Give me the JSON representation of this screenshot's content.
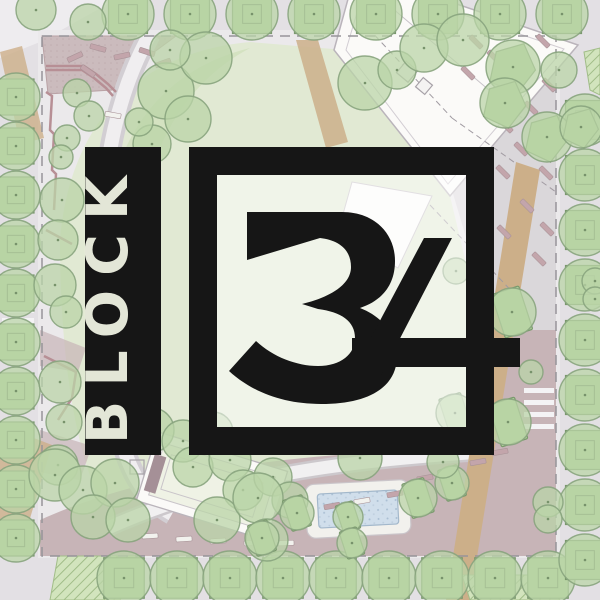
{
  "logo": {
    "block_label": "BLOCK",
    "number": "34",
    "colors": {
      "bar": "#161616",
      "frame": "#161616",
      "letters": "#ecefdf",
      "interior_wash": "rgba(255,255,255,0.5)"
    }
  },
  "site_plan": {
    "palette": {
      "street": "#e1dee2",
      "sidewalk": "#eae8ea",
      "lawn": "#dfe8d0",
      "lawn_bright": "#cfdfba",
      "tree_fill": "#b6d2a2",
      "tree_stroke": "#7f9d74",
      "planter_fill": "#abcd94",
      "planter_stroke": "#6f9161",
      "plaza_mauve": "#c8b6b8",
      "plaza_south": "#c3afb2",
      "plaza_gray": "#d8d4d8",
      "path_gray": "#cfcbd0",
      "path_light": "#efedef",
      "building": "#fbfaf8",
      "building_stroke": "#b5afb6",
      "tan_path": "#c9a981",
      "water": "#cddcea",
      "water_stroke": "#9db3c8",
      "wall": "#b2878d",
      "dash_line": "#8f8c92",
      "hatch": "#cfe2b8",
      "bench_mauve": "#bf9fa5",
      "bench_white": "#f2f1ed"
    },
    "tree_rows": [
      {
        "axis": "h",
        "y": 14,
        "x0": 128,
        "dx": 62,
        "n": 8,
        "r": 26,
        "p": "sq"
      },
      {
        "axis": "h",
        "y": 578,
        "x0": 124,
        "dx": 53,
        "n": 9,
        "r": 27,
        "p": "sq"
      },
      {
        "axis": "v",
        "x": 16,
        "y0": 97,
        "dy": 49,
        "n": 10,
        "r": 24,
        "p": "sq"
      },
      {
        "axis": "v",
        "x": 585,
        "y0": 120,
        "dy": 55,
        "n": 9,
        "r": 26,
        "p": "sq"
      }
    ],
    "trees": [
      [
        36,
        10,
        20,
        "none"
      ],
      [
        88,
        22,
        18,
        "none"
      ],
      [
        77,
        93,
        14,
        "none"
      ],
      [
        89,
        116,
        15,
        "none"
      ],
      [
        67,
        138,
        13,
        "none"
      ],
      [
        61,
        157,
        12,
        "none"
      ],
      [
        166,
        91,
        28,
        "none"
      ],
      [
        188,
        119,
        23,
        "none"
      ],
      [
        152,
        144,
        19,
        "none"
      ],
      [
        139,
        122,
        14,
        "none"
      ],
      [
        206,
        58,
        26,
        "none"
      ],
      [
        170,
        50,
        20,
        "none"
      ],
      [
        62,
        200,
        22,
        "none"
      ],
      [
        58,
        240,
        20,
        "none"
      ],
      [
        55,
        285,
        21,
        "none"
      ],
      [
        66,
        312,
        16,
        "none"
      ],
      [
        60,
        382,
        21,
        "none"
      ],
      [
        64,
        422,
        18,
        "none"
      ],
      [
        58,
        465,
        20,
        "none"
      ],
      [
        365,
        83,
        27,
        "none"
      ],
      [
        397,
        70,
        19,
        "none"
      ],
      [
        424,
        48,
        24,
        "none"
      ],
      [
        463,
        40,
        26,
        "none"
      ],
      [
        513,
        67,
        27,
        "kite"
      ],
      [
        505,
        103,
        25,
        "kite"
      ],
      [
        547,
        137,
        25,
        "kite"
      ],
      [
        581,
        127,
        21,
        "kite"
      ],
      [
        559,
        70,
        18,
        "none"
      ],
      [
        512,
        312,
        24,
        "rect"
      ],
      [
        508,
        422,
        23,
        "rect"
      ],
      [
        455,
        413,
        19,
        "rect"
      ],
      [
        452,
        483,
        17,
        "rect"
      ],
      [
        595,
        281,
        13,
        "none"
      ],
      [
        595,
        299,
        12,
        "none"
      ],
      [
        548,
        502,
        15,
        "none"
      ],
      [
        548,
        519,
        14,
        "none"
      ],
      [
        531,
        372,
        12,
        "none"
      ],
      [
        456,
        271,
        13,
        "none"
      ],
      [
        55,
        475,
        26,
        "none"
      ],
      [
        83,
        490,
        24,
        "none"
      ],
      [
        115,
        483,
        24,
        "none"
      ],
      [
        93,
        517,
        22,
        "none"
      ],
      [
        128,
        520,
        22,
        "none"
      ],
      [
        152,
        430,
        22,
        "none"
      ],
      [
        183,
        441,
        21,
        "none"
      ],
      [
        213,
        432,
        20,
        "none"
      ],
      [
        193,
        467,
        20,
        "none"
      ],
      [
        230,
        460,
        21,
        "none"
      ],
      [
        243,
        490,
        20,
        "none"
      ],
      [
        273,
        477,
        19,
        "none"
      ],
      [
        290,
        500,
        18,
        "none"
      ],
      [
        217,
        520,
        23,
        "none"
      ],
      [
        258,
        498,
        25,
        "none"
      ],
      [
        267,
        540,
        21,
        "none"
      ],
      [
        360,
        458,
        22,
        "none"
      ],
      [
        262,
        538,
        17,
        "rect"
      ],
      [
        297,
        513,
        17,
        "rect"
      ],
      [
        348,
        517,
        15,
        "rect"
      ],
      [
        352,
        543,
        15,
        "rect"
      ],
      [
        418,
        498,
        19,
        "rect"
      ],
      [
        443,
        462,
        16,
        "none"
      ]
    ],
    "benches": [
      [
        75,
        57,
        -25,
        "m"
      ],
      [
        98,
        48,
        15,
        "m"
      ],
      [
        122,
        56,
        -12,
        "m"
      ],
      [
        147,
        52,
        18,
        "m"
      ],
      [
        163,
        63,
        -20,
        "m"
      ],
      [
        88,
        71,
        35,
        "m"
      ],
      [
        476,
        42,
        45,
        "m"
      ],
      [
        494,
        57,
        45,
        "m"
      ],
      [
        543,
        41,
        45,
        "m"
      ],
      [
        468,
        73,
        45,
        "m"
      ],
      [
        549,
        85,
        45,
        "m"
      ],
      [
        531,
        108,
        45,
        "m"
      ],
      [
        506,
        126,
        45,
        "m"
      ],
      [
        521,
        149,
        45,
        "m"
      ],
      [
        546,
        173,
        45,
        "m"
      ],
      [
        503,
        172,
        45,
        "m"
      ],
      [
        527,
        206,
        45,
        "m"
      ],
      [
        547,
        229,
        45,
        "m"
      ],
      [
        539,
        259,
        45,
        "m"
      ],
      [
        504,
        232,
        45,
        "m"
      ],
      [
        425,
        478,
        -10,
        "m"
      ],
      [
        452,
        487,
        -10,
        "w"
      ],
      [
        478,
        462,
        -10,
        "m"
      ],
      [
        500,
        452,
        -10,
        "m"
      ],
      [
        395,
        494,
        -10,
        "m"
      ],
      [
        362,
        501,
        -10,
        "w"
      ],
      [
        332,
        506,
        -10,
        "m"
      ],
      [
        150,
        536,
        -4,
        "w"
      ],
      [
        184,
        539,
        -4,
        "w"
      ],
      [
        218,
        541,
        -4,
        "w"
      ],
      [
        252,
        543,
        -3,
        "w"
      ],
      [
        286,
        543,
        -2,
        "w"
      ],
      [
        113,
        115,
        10,
        "w"
      ]
    ]
  }
}
